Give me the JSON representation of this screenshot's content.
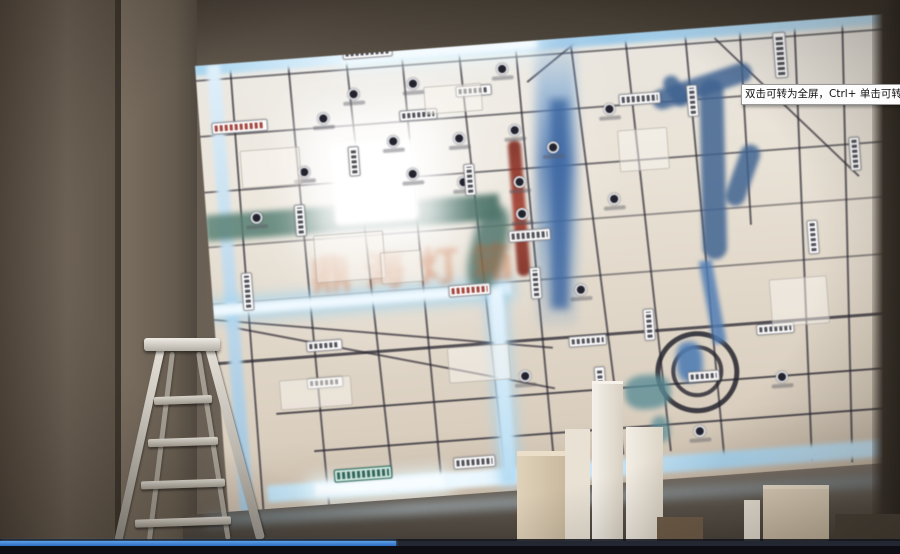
{
  "video_player": {
    "tooltip_text": "双击可转为全屏，Ctrl+ 单击可转为",
    "progress": {
      "percent_played": 44
    },
    "colors": {
      "played": "#3f87e0",
      "track": "#232731"
    }
  },
  "scene": {
    "map_watermark_text": "鼎海灯箱",
    "glow_color": "#bfe4ff",
    "site_marker_color": "#8c2f24",
    "map_background": "#e9e2d6",
    "wall_color": "#60564a"
  }
}
